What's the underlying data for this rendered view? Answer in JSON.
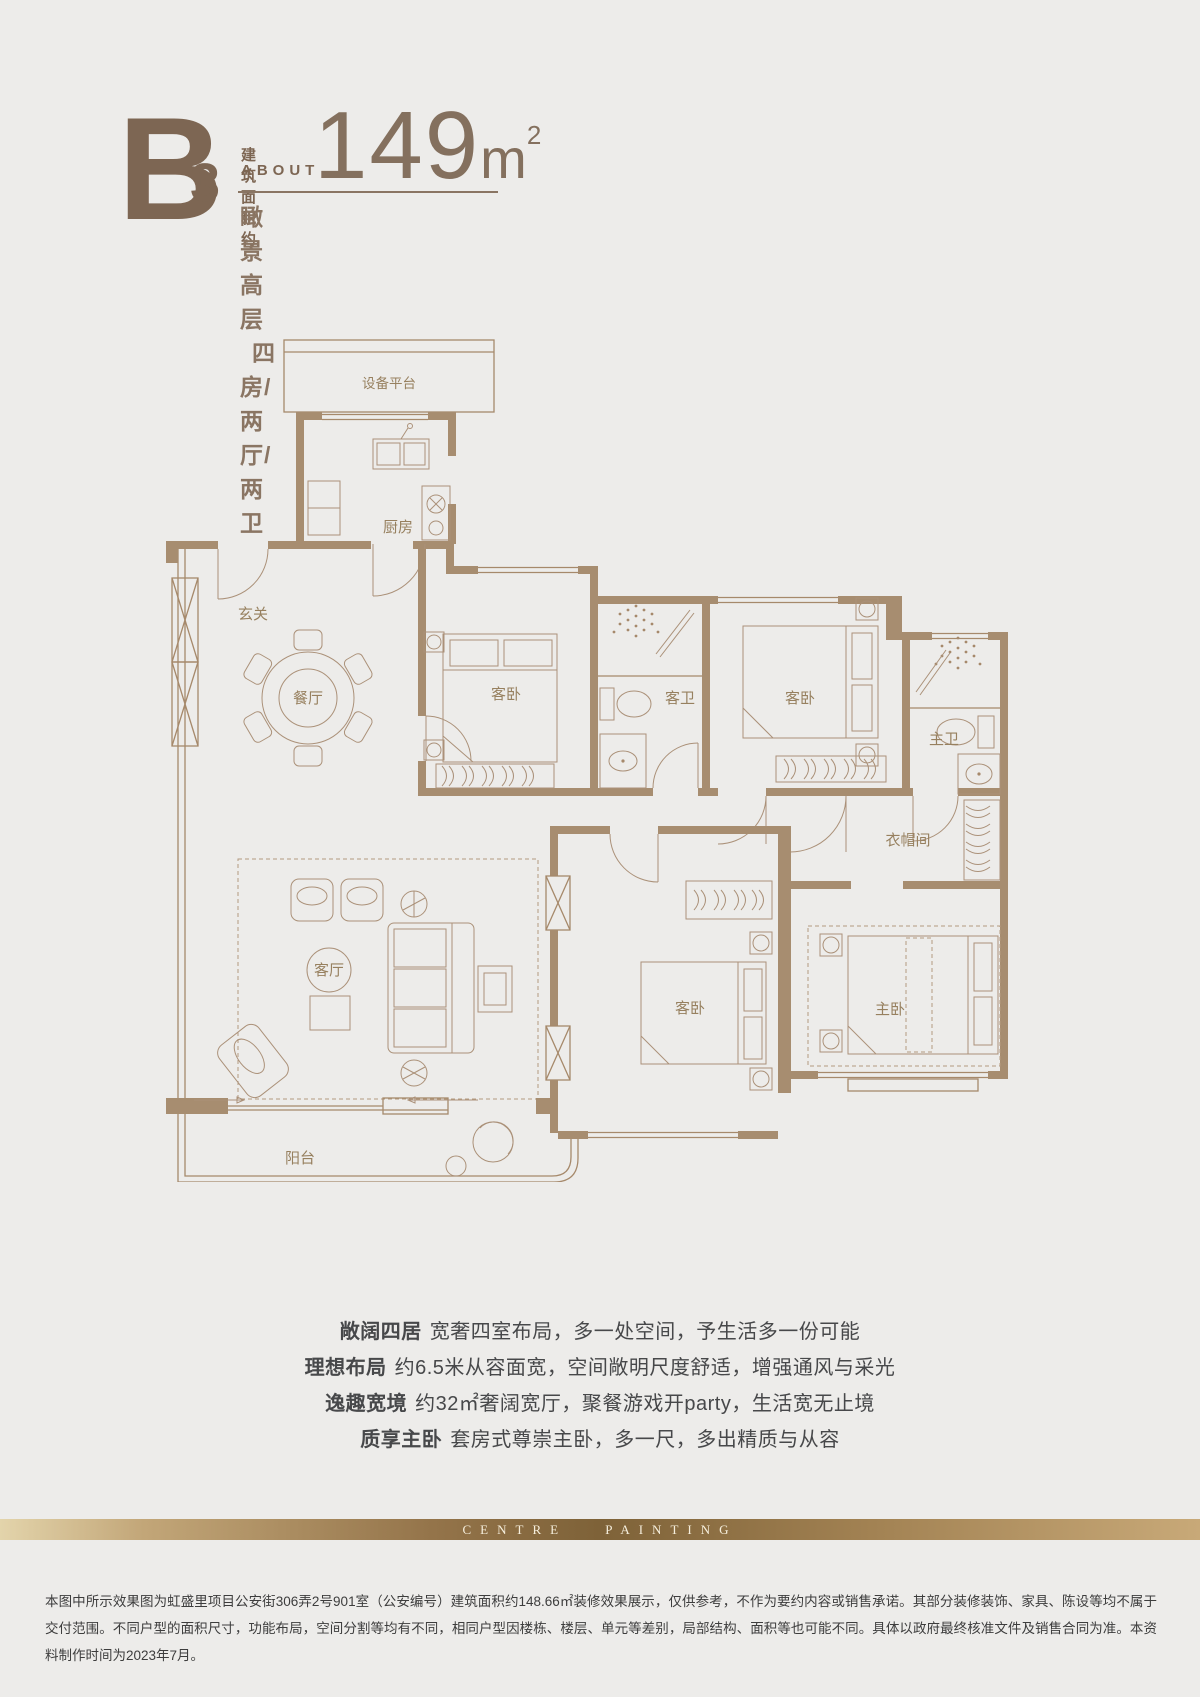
{
  "page": {
    "background": "#edecea"
  },
  "header": {
    "unit": "B",
    "unit_sub": "3",
    "area_label_cn": "建筑面积约",
    "area_label_en": "ABOUT",
    "area_value": "149",
    "area_unit": "m",
    "area_sup": "2",
    "subtitle_type": "瞰景高层",
    "subtitle_layout": "四房/两厅/两卫",
    "accent_color": "#7d6653"
  },
  "floorplan": {
    "line_color": "#a6896b",
    "wall_color": "#a78d70",
    "label_color": "#97805f",
    "rooms": {
      "equipment": "设备平台",
      "kitchen": "厨房",
      "foyer": "玄关",
      "dining": "餐厅",
      "bedroom1": "客卧",
      "guest_bath": "客卫",
      "bedroom2": "客卧",
      "master_bath": "主卫",
      "cloakroom": "衣帽间",
      "living": "客厅",
      "bedroom3": "客卧",
      "master_bedroom": "主卧",
      "balcony": "阳台"
    }
  },
  "features": [
    {
      "lead": "敞阔四居",
      "text": "宽奢四室布局，多一处空间，予生活多一份可能"
    },
    {
      "lead": "理想布局",
      "text": "约6.5米从容面宽，空间敞明尺度舒适，增强通风与采光"
    },
    {
      "lead": "逸趣宽境",
      "text": "约32㎡奢阔宽厅，聚餐游戏开party，生活宽无止境"
    },
    {
      "lead": "质享主卧",
      "text": "套房式尊崇主卧，多一尺，多出精质与从容"
    }
  ],
  "band": {
    "text": "CENTRE PAINTING",
    "gradient_from": "#e3d4ab",
    "gradient_mid": "#7e6238",
    "gradient_to": "#c8a978"
  },
  "disclaimer": "本图中所示效果图为虹盛里项目公安街306弄2号901室（公安编号）建筑面积约148.66㎡装修效果展示，仅供参考，不作为要约内容或销售承诺。其部分装修装饰、家具、陈设等均不属于交付范围。不同户型的面积尺寸，功能布局，空间分割等均有不同，相同户型因楼栋、楼层、单元等差别，局部结构、面积等也可能不同。具体以政府最终核准文件及销售合同为准。本资料制作时间为2023年7月。"
}
